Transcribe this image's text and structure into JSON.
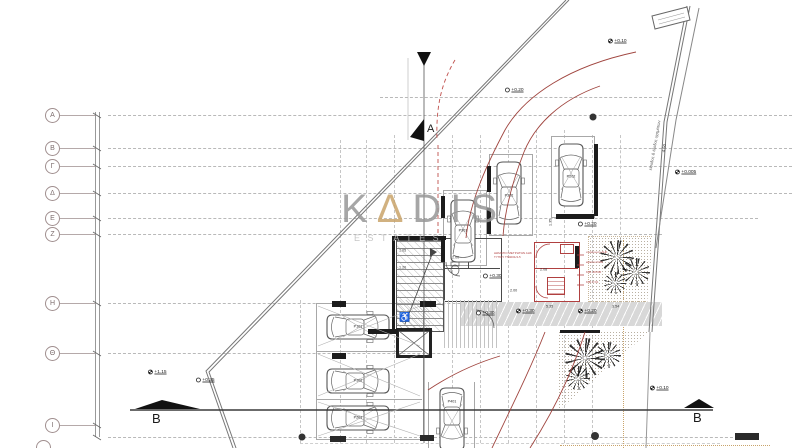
{
  "watermark": {
    "k": "K",
    "a": "Δ",
    "rest": "DIS",
    "subtitle": "ESTATES",
    "accent_color": "#c9a46b"
  },
  "grid": {
    "rows": [
      {
        "label": "Α"
      },
      {
        "label": "Β"
      },
      {
        "label": "Γ"
      },
      {
        "label": "Δ"
      },
      {
        "label": "Ε"
      },
      {
        "label": "Ζ"
      },
      {
        "label": "Η"
      },
      {
        "label": "Θ"
      },
      {
        "label": "Ι"
      }
    ]
  },
  "sections": {
    "a": "A",
    "b_left": "B",
    "b_right": "B"
  },
  "parking": [
    {
      "label": "P301"
    },
    {
      "label": "P302"
    },
    {
      "label": "P202"
    },
    {
      "label": "P101"
    },
    {
      "label": "P102"
    },
    {
      "label": "P201"
    },
    {
      "label": "P401"
    }
  ],
  "levels": [
    {
      "text": "+0.10"
    },
    {
      "text": "+0.20"
    },
    {
      "text": "+0.005"
    },
    {
      "text": "+0.20"
    },
    {
      "text": "+0.30"
    },
    {
      "text": "+0.30"
    },
    {
      "text": "+0.30"
    },
    {
      "text": "+0.20"
    },
    {
      "text": "+0.35"
    },
    {
      "text": "+1.15"
    },
    {
      "text": "+0.10"
    }
  ],
  "dimensions": [
    {
      "text": "1.05"
    },
    {
      "text": "1.20"
    },
    {
      "text": "2.00"
    },
    {
      "text": "2.08"
    },
    {
      "text": "2.00"
    },
    {
      "text": "5.35"
    },
    {
      "text": "3.54"
    },
    {
      "text": "1.35"
    },
    {
      "text": "4.50"
    }
  ],
  "driveway": {
    "label": "είσοδος & έξοδος οχημάτων"
  },
  "meter_room": {
    "line1": "ΔΩΜΑΤΙΟ ΜΕΤΡΗΤΩΝ ΑΗΚ",
    "line2": "ΤΥΠΟΥ TS4001/4-5",
    "side_labels": [
      {
        "text": "σωλήνωση ΑΗΚ"
      },
      {
        "text": "κιβώτιο ΚΟΑ"
      },
      {
        "text": "ΚΙΒ. 40Χ40"
      },
      {
        "text": "ΚΙΒ. ΚΥΑ"
      }
    ]
  },
  "symbols": {
    "wheelchair": "♿"
  },
  "colors": {
    "red_annotation": "#b04040",
    "tan": "#c9a46b",
    "grid_gray": "#b9b9b9"
  }
}
